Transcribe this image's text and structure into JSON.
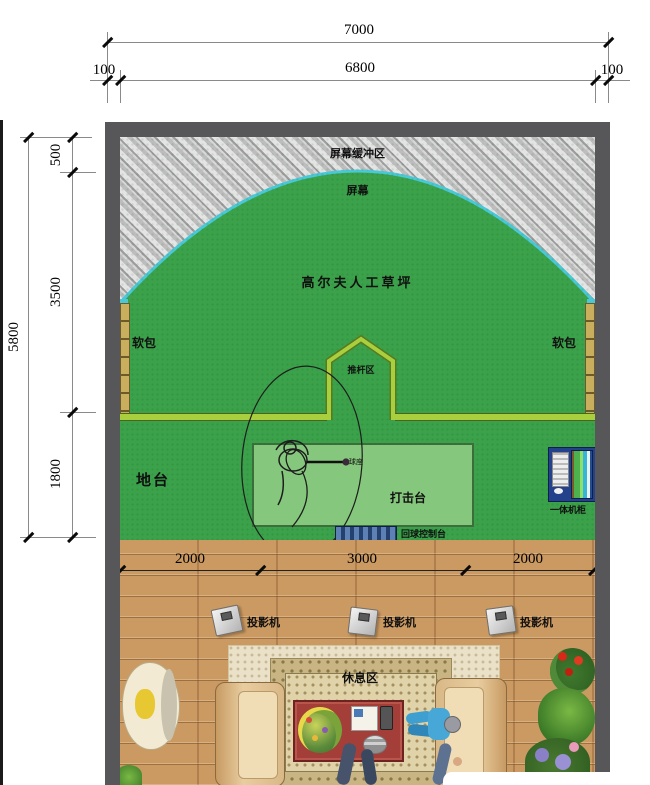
{
  "dimensions_top": {
    "overall": "7000",
    "wall_left": "100",
    "inner": "6800",
    "wall_right": "100"
  },
  "dimensions_left": {
    "overall": "5800",
    "screen_buffer_depth": "500",
    "turf_depth": "3500",
    "platform_depth": "1800"
  },
  "dimensions_floor": {
    "left": "2000",
    "center": "3000",
    "right": "2000"
  },
  "labels": {
    "screen_buffer": "屏幕缓冲区",
    "screen": "屏幕",
    "turf": "高尔夫人工草坪",
    "soft_pad": "软包",
    "putting_zone": "推杆区",
    "platform": "地台",
    "hitting_mat": "打击台",
    "ball_tee": "球座",
    "ball_return": "回球控制台",
    "cabinet": "一体机柜",
    "projector": "投影机",
    "rest_area": "休息区"
  },
  "colors": {
    "wall": "#57575a",
    "turf_green": "#3ba24b",
    "screen_arc_cyan": "#49c8d8",
    "line_yellow_green": "#a9cf3f",
    "hitting_mat_green": "#85c87d",
    "soft_pad_tan": "#c9ae5e",
    "wood_floor": "#cb9a62",
    "carpet_beige": "#eae1c8",
    "rug_tan": "#c9b484",
    "table_red": "#a43e38",
    "cabinet_blue": "#24418c",
    "hatch_gray": "#bdbdbd"
  }
}
